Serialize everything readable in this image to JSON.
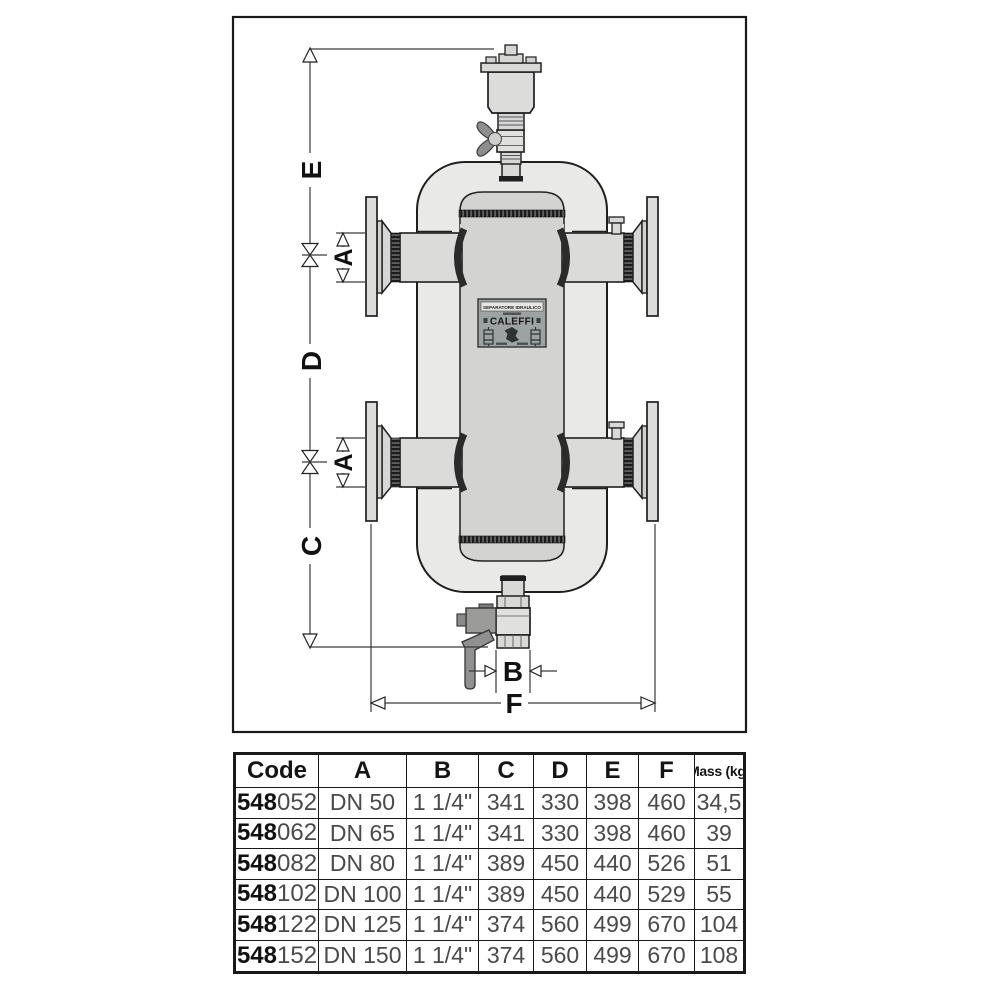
{
  "diagram": {
    "dims": {
      "E": "E",
      "D": "D",
      "C": "C",
      "A_top": "A",
      "A_bottom": "A",
      "B": "B",
      "F": "F"
    },
    "plate": {
      "title": "SEPARATORE IDRAULICO",
      "brand": "CALEFFI"
    },
    "colors": {
      "body": "#e9e9e8",
      "tube": "#d3d3d2",
      "outline": "#1f1f1f",
      "handle": "#8e8e8e",
      "plate_bg": "#9da3a3"
    }
  },
  "table": {
    "headers": [
      "Code",
      "A",
      "B",
      "C",
      "D",
      "E",
      "F",
      "Mass (kg)"
    ],
    "rows": [
      {
        "code_bold": "548",
        "code_rest": "052",
        "A": "DN 50",
        "B": "1 1/4\"",
        "C": "341",
        "D": "330",
        "E": "398",
        "F": "460",
        "mass": "34,5"
      },
      {
        "code_bold": "548",
        "code_rest": "062",
        "A": "DN 65",
        "B": "1 1/4\"",
        "C": "341",
        "D": "330",
        "E": "398",
        "F": "460",
        "mass": "39"
      },
      {
        "code_bold": "548",
        "code_rest": "082",
        "A": "DN 80",
        "B": "1 1/4\"",
        "C": "389",
        "D": "450",
        "E": "440",
        "F": "526",
        "mass": "51"
      },
      {
        "code_bold": "548",
        "code_rest": "102",
        "A": "DN 100",
        "B": "1 1/4\"",
        "C": "389",
        "D": "450",
        "E": "440",
        "F": "529",
        "mass": "55"
      },
      {
        "code_bold": "548",
        "code_rest": "122",
        "A": "DN 125",
        "B": "1 1/4\"",
        "C": "374",
        "D": "560",
        "E": "499",
        "F": "670",
        "mass": "104"
      },
      {
        "code_bold": "548",
        "code_rest": "152",
        "A": "DN 150",
        "B": "1 1/4\"",
        "C": "374",
        "D": "560",
        "E": "499",
        "F": "670",
        "mass": "108"
      }
    ]
  }
}
